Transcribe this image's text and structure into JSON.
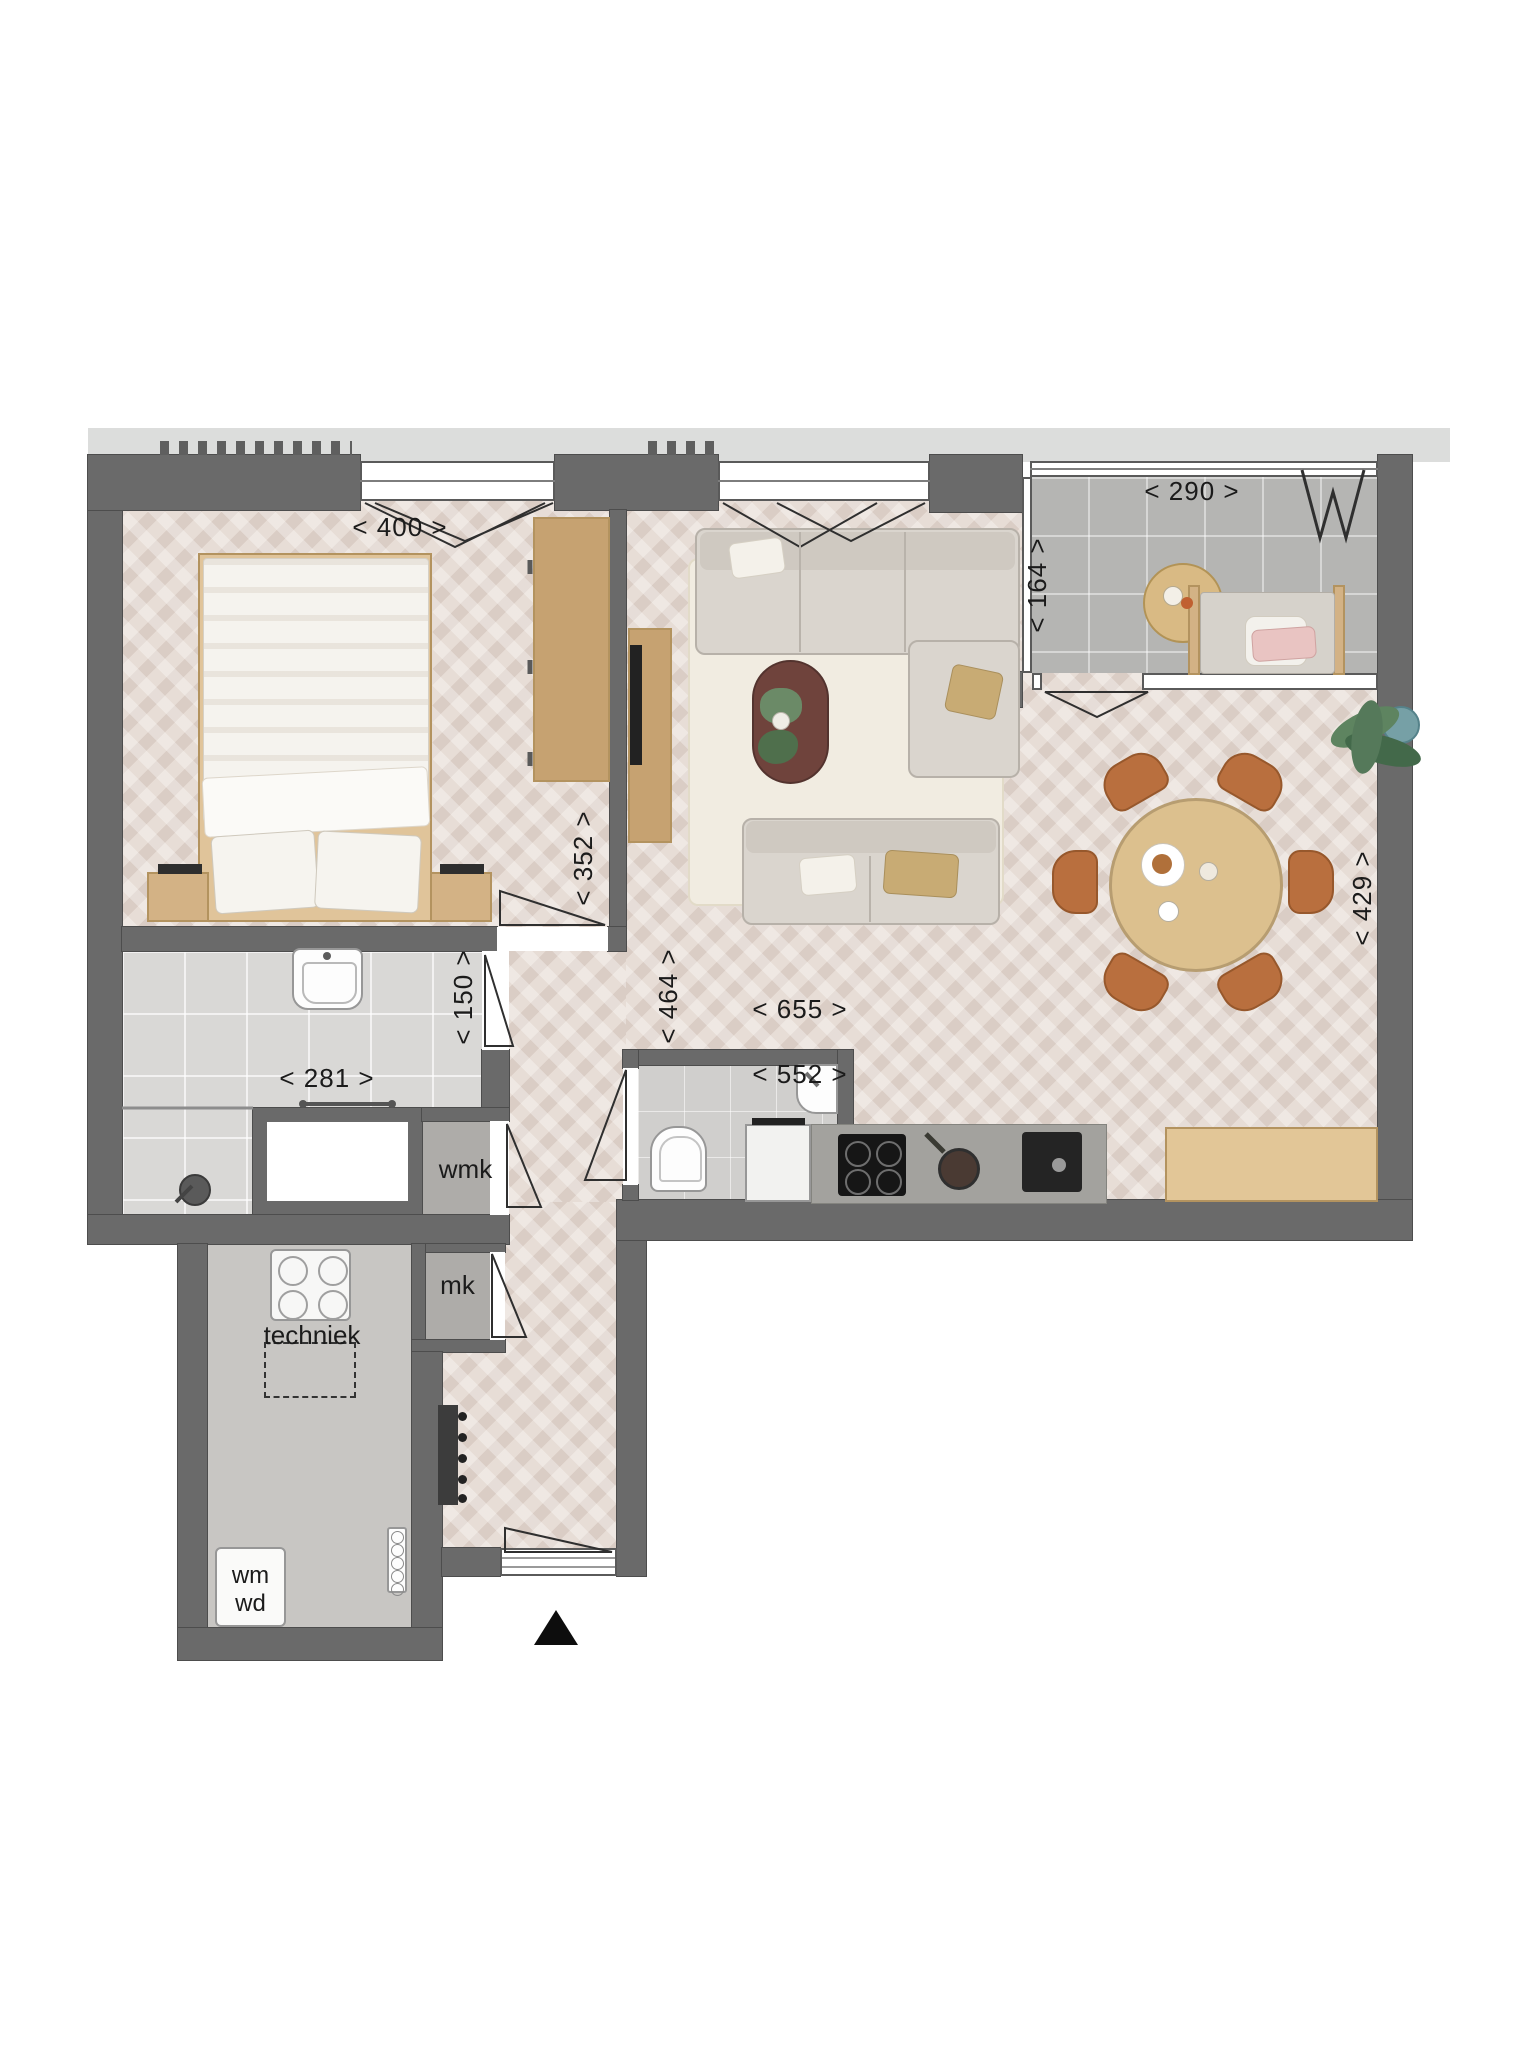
{
  "dims": {
    "d400": "< 400 >",
    "d290": "< 290 >",
    "d164": "< 164 >",
    "d352": "< 352 >",
    "d150": "< 150 >",
    "d281": "< 281 >",
    "d464": "< 464 >",
    "d655": "< 655 >",
    "d552": "< 552 >",
    "d429": "< 429 >"
  },
  "labels": {
    "wmk": "wmk",
    "mk": "mk",
    "techniek": "techniek",
    "wm": "wm",
    "wd": "wd"
  },
  "colors": {
    "wall": "#6a6a6a",
    "wood_floor": "#e7ddd6",
    "balcony_tile": "#b5b5b3",
    "wood_furniture": "#d3b285",
    "dining_chair": "#b96f3e",
    "sofa": "#dad5ce",
    "exterior_band": "#dcdddc"
  }
}
